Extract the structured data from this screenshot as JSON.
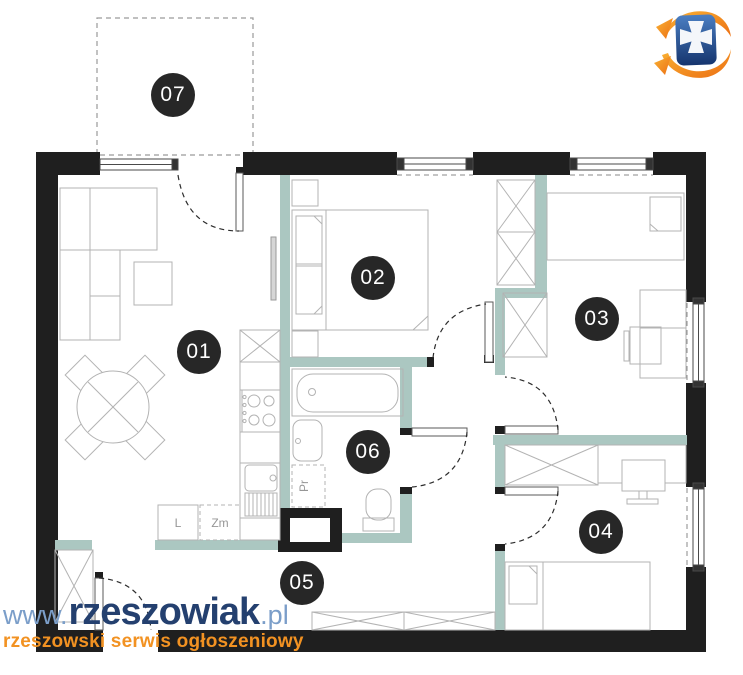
{
  "plan": {
    "room_labels": [
      "01",
      "02",
      "03",
      "04",
      "05",
      "06",
      "07"
    ],
    "kitchen": {
      "fridge_label": "L",
      "dishwasher_label": "Zm"
    },
    "bathroom": {
      "washing_machine_label": "Pr"
    }
  },
  "watermark": {
    "prefix": "www.",
    "brand": "rzeszowiak",
    "tld": ".pl",
    "tagline": "rzeszowski serwis ogłoszeniowy"
  },
  "colors": {
    "wall": "#1f1f1f",
    "partition": "#abc7c1",
    "label_background": "#272727",
    "brand_navy": "#24406f",
    "brand_light_blue": "#7b9ec9",
    "brand_orange": "#f29222",
    "logo_blue": "#2a4f96",
    "furniture_line": "#b3b3b3"
  }
}
